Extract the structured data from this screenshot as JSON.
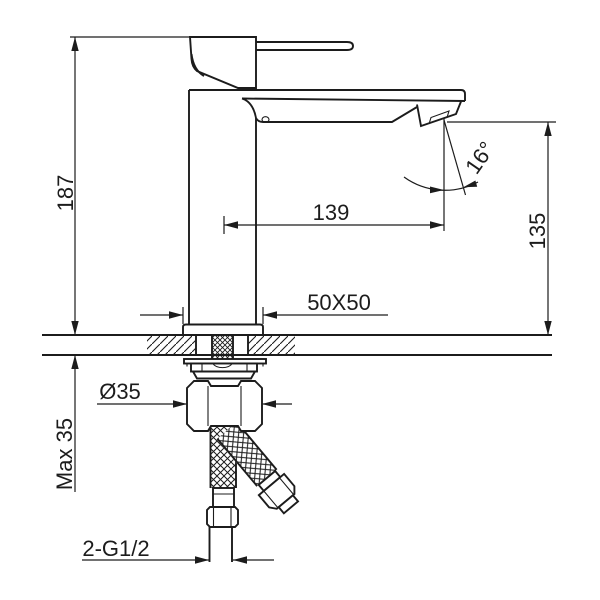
{
  "drawing": {
    "background": "#ffffff",
    "line_color": "#1c1c1c",
    "subject": "single-lever basin faucet side elevation with installation dimensions",
    "labels": {
      "overall_height": "187",
      "spout_reach": "139",
      "spout_angle": "16°",
      "outlet_height": "135",
      "base_size": "50X50",
      "hole_diameter": "Ø35",
      "max_counter_thickness": "Max 35",
      "inlet_thread": "2-G1/2"
    }
  }
}
